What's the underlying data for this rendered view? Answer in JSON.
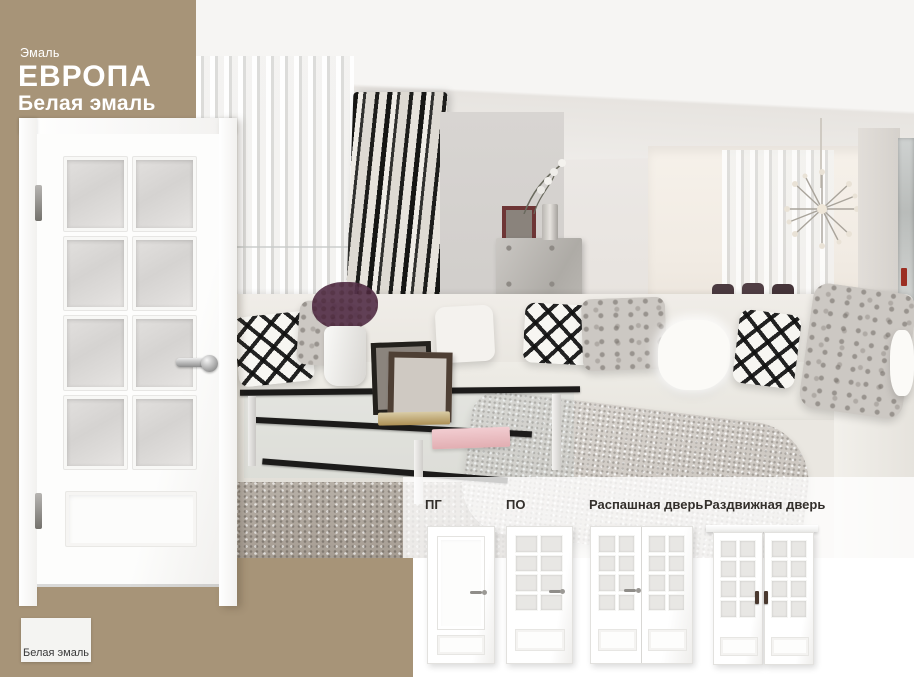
{
  "colors": {
    "background_tan": "#a79478",
    "panel_overlay": "rgba(255,255,255,0.78)",
    "door_white": "#fbfbfa",
    "glass_gray": "#dcdad8",
    "heading_text": "#ffffff",
    "label_text": "#332f2b",
    "swatch_fill": "#f4f4f2"
  },
  "header": {
    "category": "Эмаль",
    "title": "ЕВРОПА",
    "subtitle": "Белая эмаль"
  },
  "swatch": {
    "label": "Белая эмаль"
  },
  "main_door": {
    "glass_rows": 4,
    "glass_cols": 2
  },
  "variants": {
    "items": [
      {
        "id": "pg",
        "label": "ПГ"
      },
      {
        "id": "po",
        "label": "ПО"
      },
      {
        "id": "raspashnaya",
        "label": "Распашная дверь"
      },
      {
        "id": "razdvizhnaya",
        "label": "Раздвижная дверь"
      }
    ]
  }
}
